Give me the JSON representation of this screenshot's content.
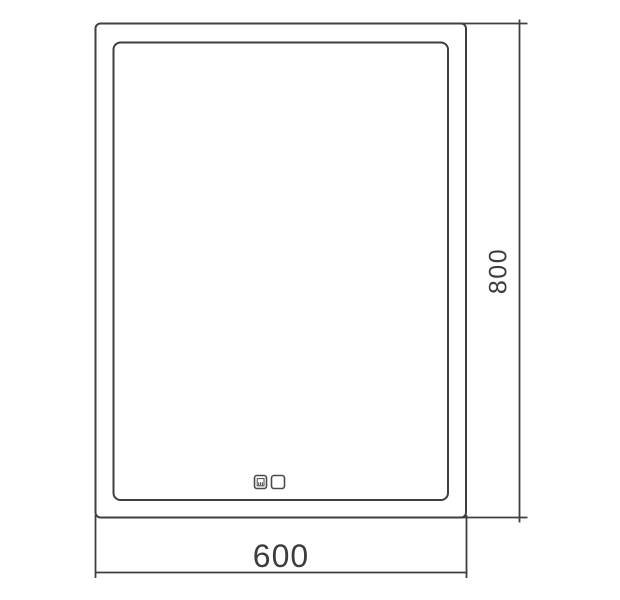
{
  "drawing": {
    "kind": "mirror-front-view-dimension-drawing",
    "dimension_width": "600",
    "dimension_height": "800",
    "line_color": "#3f3f3f",
    "text_color": "#3d3d3d",
    "background_color": "#ffffff",
    "icons": [
      "clock-display-icon",
      "touch-sensor-icon"
    ]
  }
}
